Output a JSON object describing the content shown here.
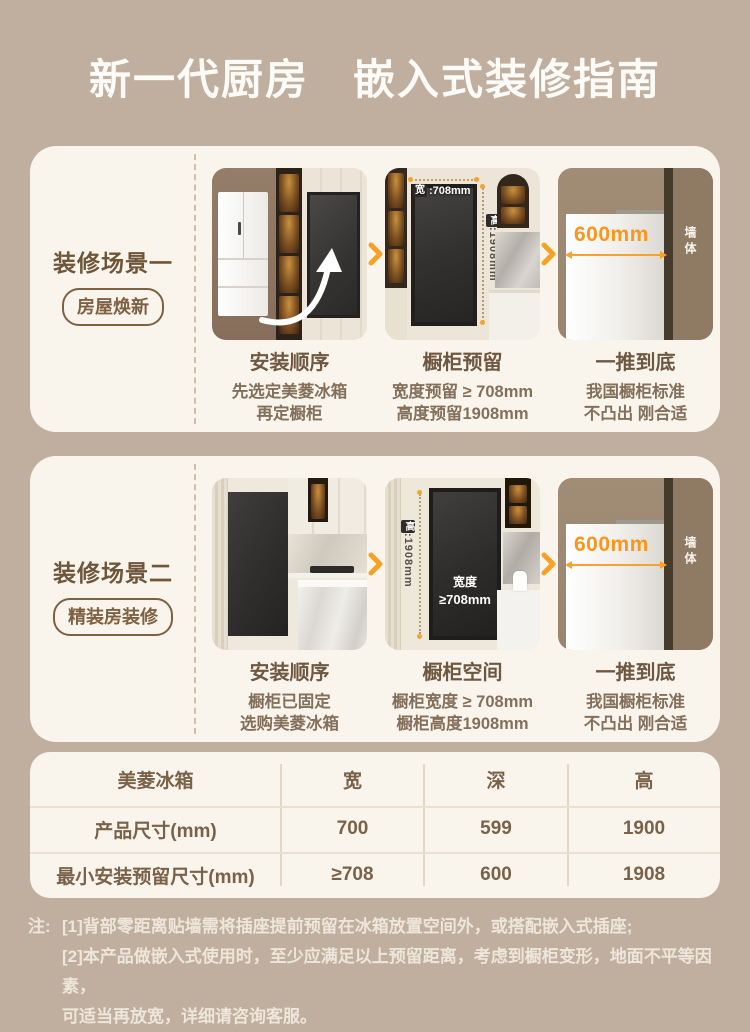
{
  "page": {
    "title": "新一代厨房　嵌入式装修指南"
  },
  "colors": {
    "page_bg": "#c0af9f",
    "card_bg": "#faf5ec",
    "accent_orange": "#f7a125",
    "brand_brown": "#6f5539",
    "dimension_orange": "#f8961d"
  },
  "scenes": [
    {
      "label": "装修场景一",
      "badge": "房屋焕新",
      "steps": [
        {
          "title": "安装顺序",
          "line1": "先选定美菱冰箱",
          "line2": "再定橱柜"
        },
        {
          "title": "橱柜预留",
          "line1": "宽度预留 ≥ 708mm",
          "line2": "高度预留1908mm"
        },
        {
          "title": "一推到底",
          "line1": "我国橱柜标准",
          "line2": "不凸出 刚合适"
        }
      ],
      "img2": {
        "width_badge": "宽",
        "width_value": ":708mm",
        "height_badge": "高",
        "height_value": ":1908mm"
      },
      "img3": {
        "depth": "600mm",
        "wall": "墙体"
      }
    },
    {
      "label": "装修场景二",
      "badge": "精装房装修",
      "steps": [
        {
          "title": "安装顺序",
          "line1": "橱柜已固定",
          "line2": "选购美菱冰箱"
        },
        {
          "title": "橱柜空间",
          "line1": "橱柜宽度 ≥ 708mm",
          "line2": "橱柜高度1908mm"
        },
        {
          "title": "一推到底",
          "line1": "我国橱柜标准",
          "line2": "不凸出 刚合适"
        }
      ],
      "img2": {
        "height_badge": "高",
        "height_value": ":1908mm",
        "recess_line1": "宽度",
        "recess_line2": "≥708mm"
      },
      "img3": {
        "depth": "600mm",
        "wall": "墙体"
      }
    }
  ],
  "table": {
    "col_headers": [
      "美菱冰箱",
      "宽",
      "深",
      "高"
    ],
    "rows": [
      [
        "产品尺寸(mm)",
        "700",
        "599",
        "1900"
      ],
      [
        "最小安装预留尺寸(mm)",
        "≥708",
        "600",
        "1908"
      ]
    ]
  },
  "notes": {
    "prefix": "注:",
    "line1": "[1]背部零距离贴墙需将插座提前预留在冰箱放置空间外，或搭配嵌入式插座;",
    "line2": "[2]本产品做嵌入式使用时，至少应满足以上预留距离，考虑到橱柜变形，地面不平等因素，",
    "line3": "可适当再放宽，详细请咨询客服。"
  }
}
